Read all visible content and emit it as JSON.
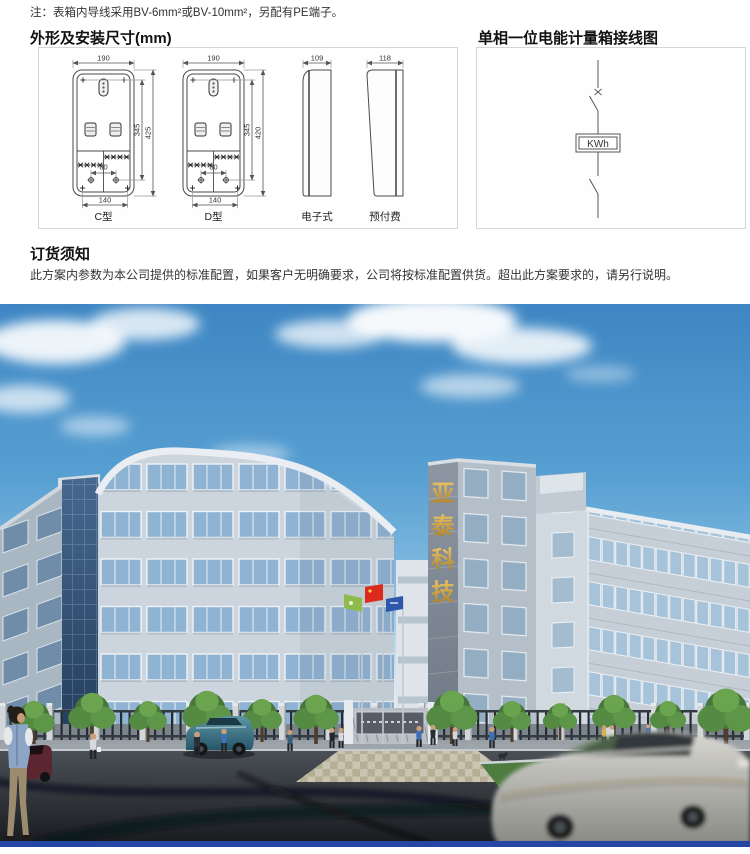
{
  "note": "注：表箱内导线采用BV-6mm²或BV-10mm²，另配有PE端子。",
  "dims_section": {
    "title": "外形及安装尺寸(mm)",
    "c": {
      "label": "C型",
      "w": "190",
      "h_inner": "345",
      "h_outer": "425",
      "w_mount": "80",
      "w_base": "140"
    },
    "d": {
      "label": "D型",
      "w": "190",
      "h_inner": "345",
      "h_outer": "420",
      "w_mount": "80",
      "w_base": "140"
    },
    "electronic": {
      "label": "电子式",
      "w": "109"
    },
    "prepaid": {
      "label": "预付费",
      "w": "118"
    }
  },
  "wiring_section": {
    "title": "单相一位电能计量箱接线图",
    "meter": "KWh"
  },
  "order_section": {
    "title": "订货须知",
    "body": "此方案内参数为本公司提供的标准配置，如果客户无明确要求，公司将按标准配置供货。超出此方案要求的，请另行说明。"
  },
  "photo": {
    "tower_sign": [
      "亚",
      "泰",
      "科",
      "技"
    ],
    "colors": {
      "sky_top": "#3e86c3",
      "sky_horizon": "#f2f9fd",
      "facade": "#c6cfd7",
      "glass": "#a6c3da",
      "curtain_wall_blue": "#2c4a74",
      "gold_sign": "#c8a13c",
      "road": "#25282d",
      "tree_green": "#4f8040",
      "flag_red": "#dc2a1c",
      "flag_green": "#8fbb4d",
      "flag_blue": "#2d57aa",
      "footer_bar": "#2646a4"
    }
  }
}
